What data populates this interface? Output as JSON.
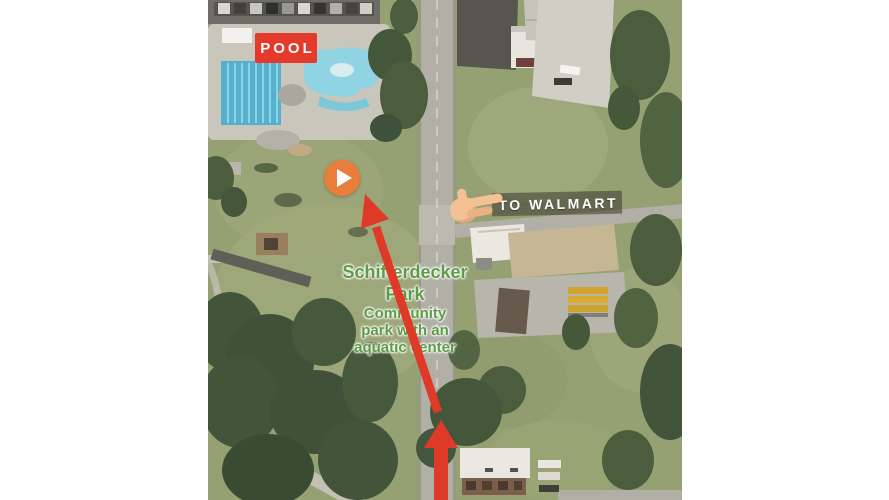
{
  "video_thumbnail": {
    "pool_badge": {
      "label": "POOL"
    },
    "walmart_sign": {
      "label": "TO WALMART",
      "icon": "pointing-hand-icon",
      "icon_glyph": "👉"
    },
    "park_label": {
      "title_lines": [
        "Schifferdecker",
        "Park"
      ],
      "subtitle_lines": [
        "Community",
        "park with an",
        "aquatic center"
      ]
    },
    "play_button": {
      "icon": "play-icon",
      "glyph": "▶"
    },
    "arrows": {
      "up": "arrow-up-icon",
      "diagonal": "arrow-diagonal-icon"
    },
    "colors": {
      "annotation_red": "#df3a28",
      "pool_badge_bg": "#e5392b",
      "play_button_bg": "#e87d3c",
      "park_label_green": "#5e9b48",
      "walmart_bar_bg": "rgba(58,56,46,0.55)",
      "label_text": "#ffffff"
    }
  }
}
